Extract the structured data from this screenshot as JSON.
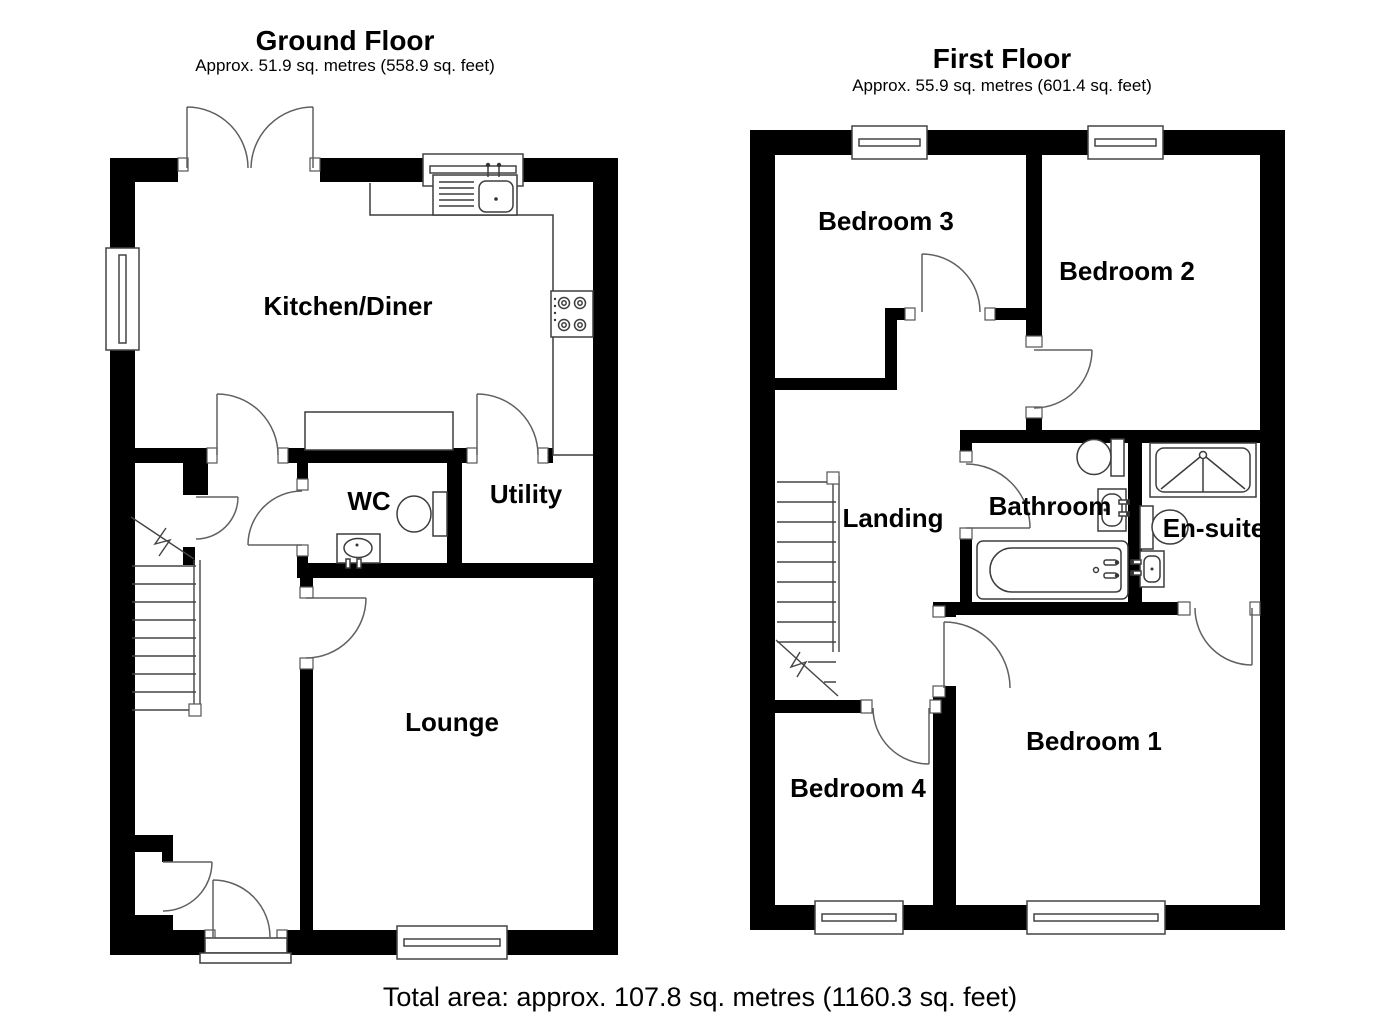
{
  "ground_floor": {
    "title": "Ground Floor",
    "subtitle": "Approx. 51.9 sq. metres (558.9 sq. feet)",
    "rooms": {
      "kitchen_diner": "Kitchen/Diner",
      "wc": "WC",
      "utility": "Utility",
      "lounge": "Lounge"
    }
  },
  "first_floor": {
    "title": "First Floor",
    "subtitle": "Approx. 55.9 sq. metres (601.4 sq. feet)",
    "rooms": {
      "bedroom3": "Bedroom 3",
      "bedroom2": "Bedroom 2",
      "landing": "Landing",
      "bathroom": "Bathroom",
      "ensuite": "En-suite",
      "bedroom4": "Bedroom 4",
      "bedroom1": "Bedroom 1"
    }
  },
  "footer": {
    "total_area": "Total area: approx. 107.8 sq. metres (1160.3 sq. feet)"
  },
  "colors": {
    "wall": "#000000",
    "line": "#3d3d3d",
    "door_arc": "#606060",
    "background": "#ffffff",
    "text": "#000000"
  }
}
